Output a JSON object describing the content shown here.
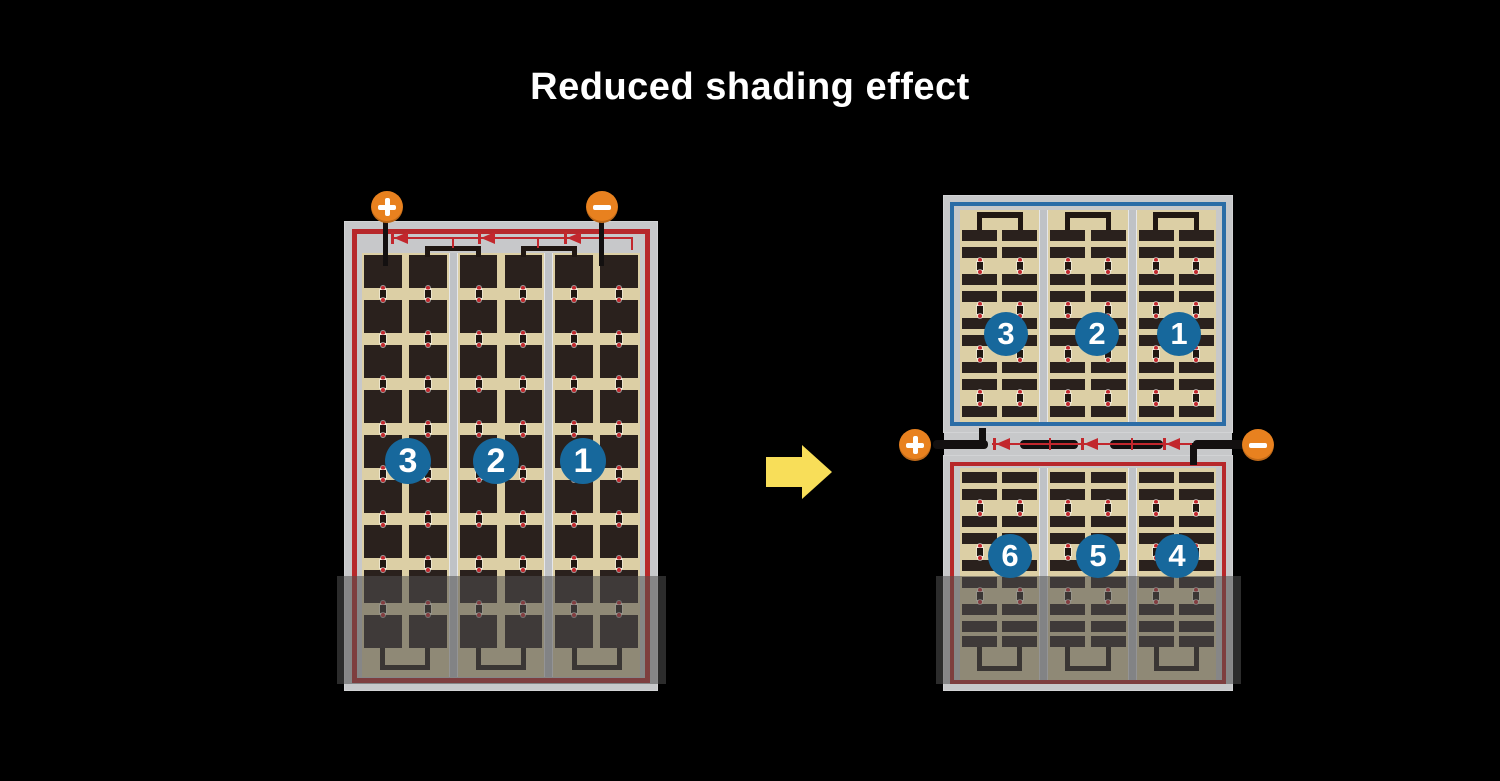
{
  "title": "Reduced shading effect",
  "colors": {
    "background": "#000000",
    "panel_frame": "#c7c8ca",
    "red_border": "#b7282b",
    "blue_border": "#2b6ca6",
    "cell_area_tan": "#dccfa5",
    "cell_dark": "#2a211d",
    "divider_gray": "#bfc2c6",
    "trace_black": "#201712",
    "lead_black": "#131010",
    "diode_red": "#c2272d",
    "terminal_orange": "#e8811f",
    "number_circle_blue": "#17689c",
    "arrow_yellow": "#f8de59",
    "shading_overlay": "rgba(80,80,80,0.55)"
  },
  "left_module": {
    "description": "full-cell module, single circuit, bottom row shaded",
    "terminals": [
      {
        "symbol": "+"
      },
      {
        "symbol": "−"
      }
    ],
    "bypass_diodes": 3,
    "cell_strings": [
      {
        "label": "3"
      },
      {
        "label": "2"
      },
      {
        "label": "1"
      }
    ],
    "shaded_bottom": true
  },
  "arrow": {
    "direction": "right"
  },
  "right_modules": {
    "description": "half-cell module split into two circuits, bottom shaded",
    "terminals": [
      {
        "symbol": "+"
      },
      {
        "symbol": "−"
      }
    ],
    "bypass_diodes": 3,
    "top_module": {
      "border": "blue",
      "cell_strings": [
        {
          "label": "3"
        },
        {
          "label": "2"
        },
        {
          "label": "1"
        }
      ],
      "shaded_bottom": false
    },
    "bottom_module": {
      "border": "red",
      "cell_strings": [
        {
          "label": "6"
        },
        {
          "label": "5"
        },
        {
          "label": "4"
        }
      ],
      "shaded_bottom": true
    }
  }
}
